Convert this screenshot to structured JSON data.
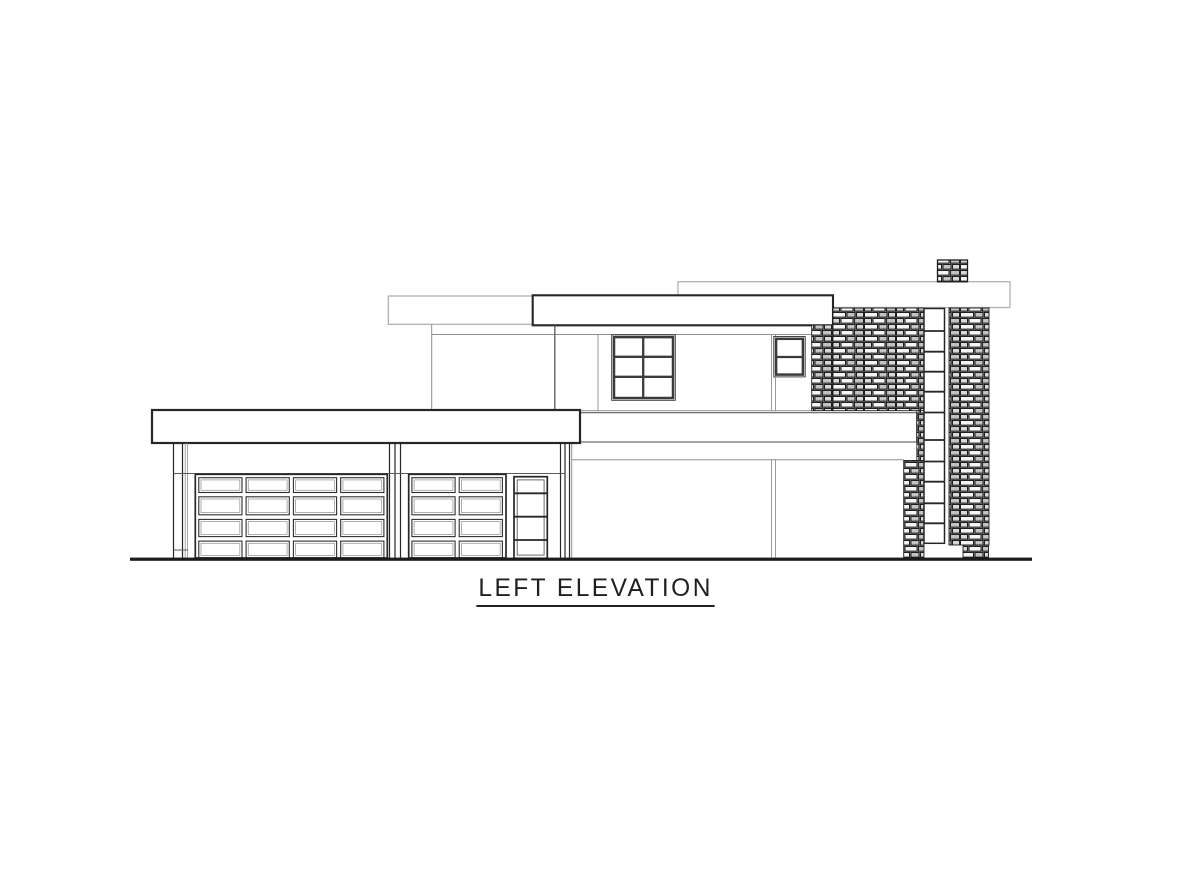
{
  "sheet": {
    "title": "LEFT ELEVATION"
  },
  "colors": {
    "bg": "#ffffff",
    "ink": "#262626",
    "mid": "#5a5a5a",
    "light-line": "#8f8f8f",
    "faint-line": "#b0b0b0",
    "ground": "#1c1c1c",
    "stone-mortar": "#8a8a8a",
    "stone-outline": "#1f1f1f",
    "stone-light": "#f5f5f5",
    "stone-mid": "#d8d8d8",
    "stone-dark": "#c3c3c3",
    "title-ink": "#1f1f1f"
  }
}
